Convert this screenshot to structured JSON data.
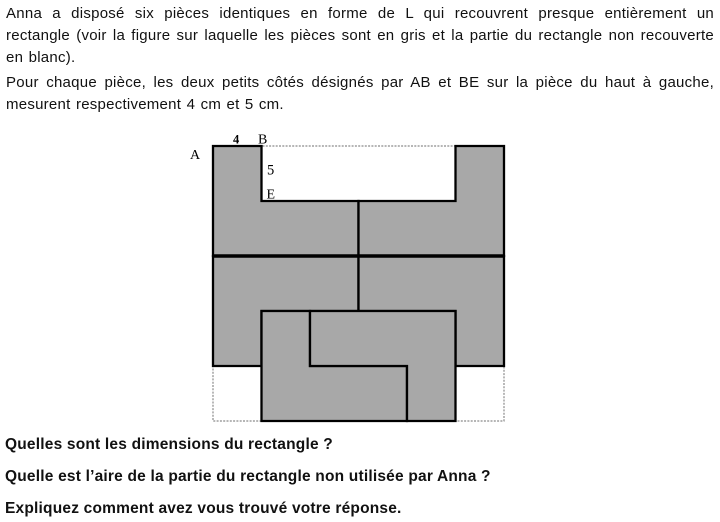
{
  "intro": {
    "para1": {
      "lines": [
        "Anna a disposé six pièces identiques en forme de L qui recouvrent presque entièrement un",
        "rectangle (voir la figure sur laquelle les pièces sont en gris et la partie du rectangle non recouverte",
        "en blanc)."
      ]
    },
    "para2": {
      "lines": [
        "Pour chaque pièce, les deux petits côtés désignés par AB et BE sur la pièce du haut à gauche,",
        "mesurent respectivement 4 cm et 5 cm."
      ]
    }
  },
  "figure": {
    "description": "Six gray L-shaped pieces arranged inside a dashed rectangle; uncovered parts are white",
    "rectangle_cm": {
      "width": 24,
      "height": 25
    },
    "piece_small_sides": {
      "AB": "4",
      "BE": "5"
    },
    "colors": {
      "piece_fill": "#a8a8a8",
      "piece_stroke": "#000000",
      "dashed_outline": "#8a8a8a"
    },
    "layout": {
      "origin_px": {
        "x": 33,
        "y": 18
      },
      "scale_px_per_cm": {
        "x": 12.125,
        "y": 11
      }
    },
    "pieces_cm": [
      [
        [
          0,
          0
        ],
        [
          4,
          0
        ],
        [
          4,
          5
        ],
        [
          12,
          5
        ],
        [
          12,
          10
        ],
        [
          0,
          10
        ]
      ],
      [
        [
          20,
          0
        ],
        [
          24,
          0
        ],
        [
          24,
          10
        ],
        [
          12,
          10
        ],
        [
          12,
          5
        ],
        [
          20,
          5
        ]
      ],
      [
        [
          0,
          10
        ],
        [
          12,
          10
        ],
        [
          12,
          15
        ],
        [
          4,
          15
        ],
        [
          4,
          20
        ],
        [
          0,
          20
        ]
      ],
      [
        [
          12,
          10
        ],
        [
          24,
          10
        ],
        [
          24,
          20
        ],
        [
          20,
          20
        ],
        [
          20,
          15
        ],
        [
          12,
          15
        ]
      ],
      [
        [
          4,
          15
        ],
        [
          8,
          15
        ],
        [
          8,
          20
        ],
        [
          16,
          20
        ],
        [
          16,
          25
        ],
        [
          4,
          25
        ]
      ],
      [
        [
          8,
          15
        ],
        [
          20,
          15
        ],
        [
          20,
          25
        ],
        [
          16,
          25
        ],
        [
          16,
          20
        ],
        [
          8,
          20
        ]
      ]
    ],
    "divider_cm": {
      "x1": 0,
      "y1": 10,
      "x2": 24,
      "y2": 10
    },
    "labels": [
      {
        "text": "A",
        "x": 10,
        "y": 31,
        "size": 14,
        "bold": false
      },
      {
        "text": "4",
        "x": 53,
        "y": 15.5,
        "size": 12.5,
        "bold": true
      },
      {
        "text": "B",
        "x": 78,
        "y": 15.5,
        "size": 14,
        "bold": false
      },
      {
        "text": "5",
        "x": 87,
        "y": 46.5,
        "size": 14.5,
        "bold": false
      },
      {
        "text": "E",
        "x": 86.5,
        "y": 70.5,
        "size": 14,
        "bold": false
      }
    ]
  },
  "questions": [
    "Quelles sont les dimensions du rectangle ?",
    "Quelle est l’aire de la partie du rectangle non utilisée par Anna ?",
    "Expliquez comment avez vous trouvé votre réponse."
  ]
}
